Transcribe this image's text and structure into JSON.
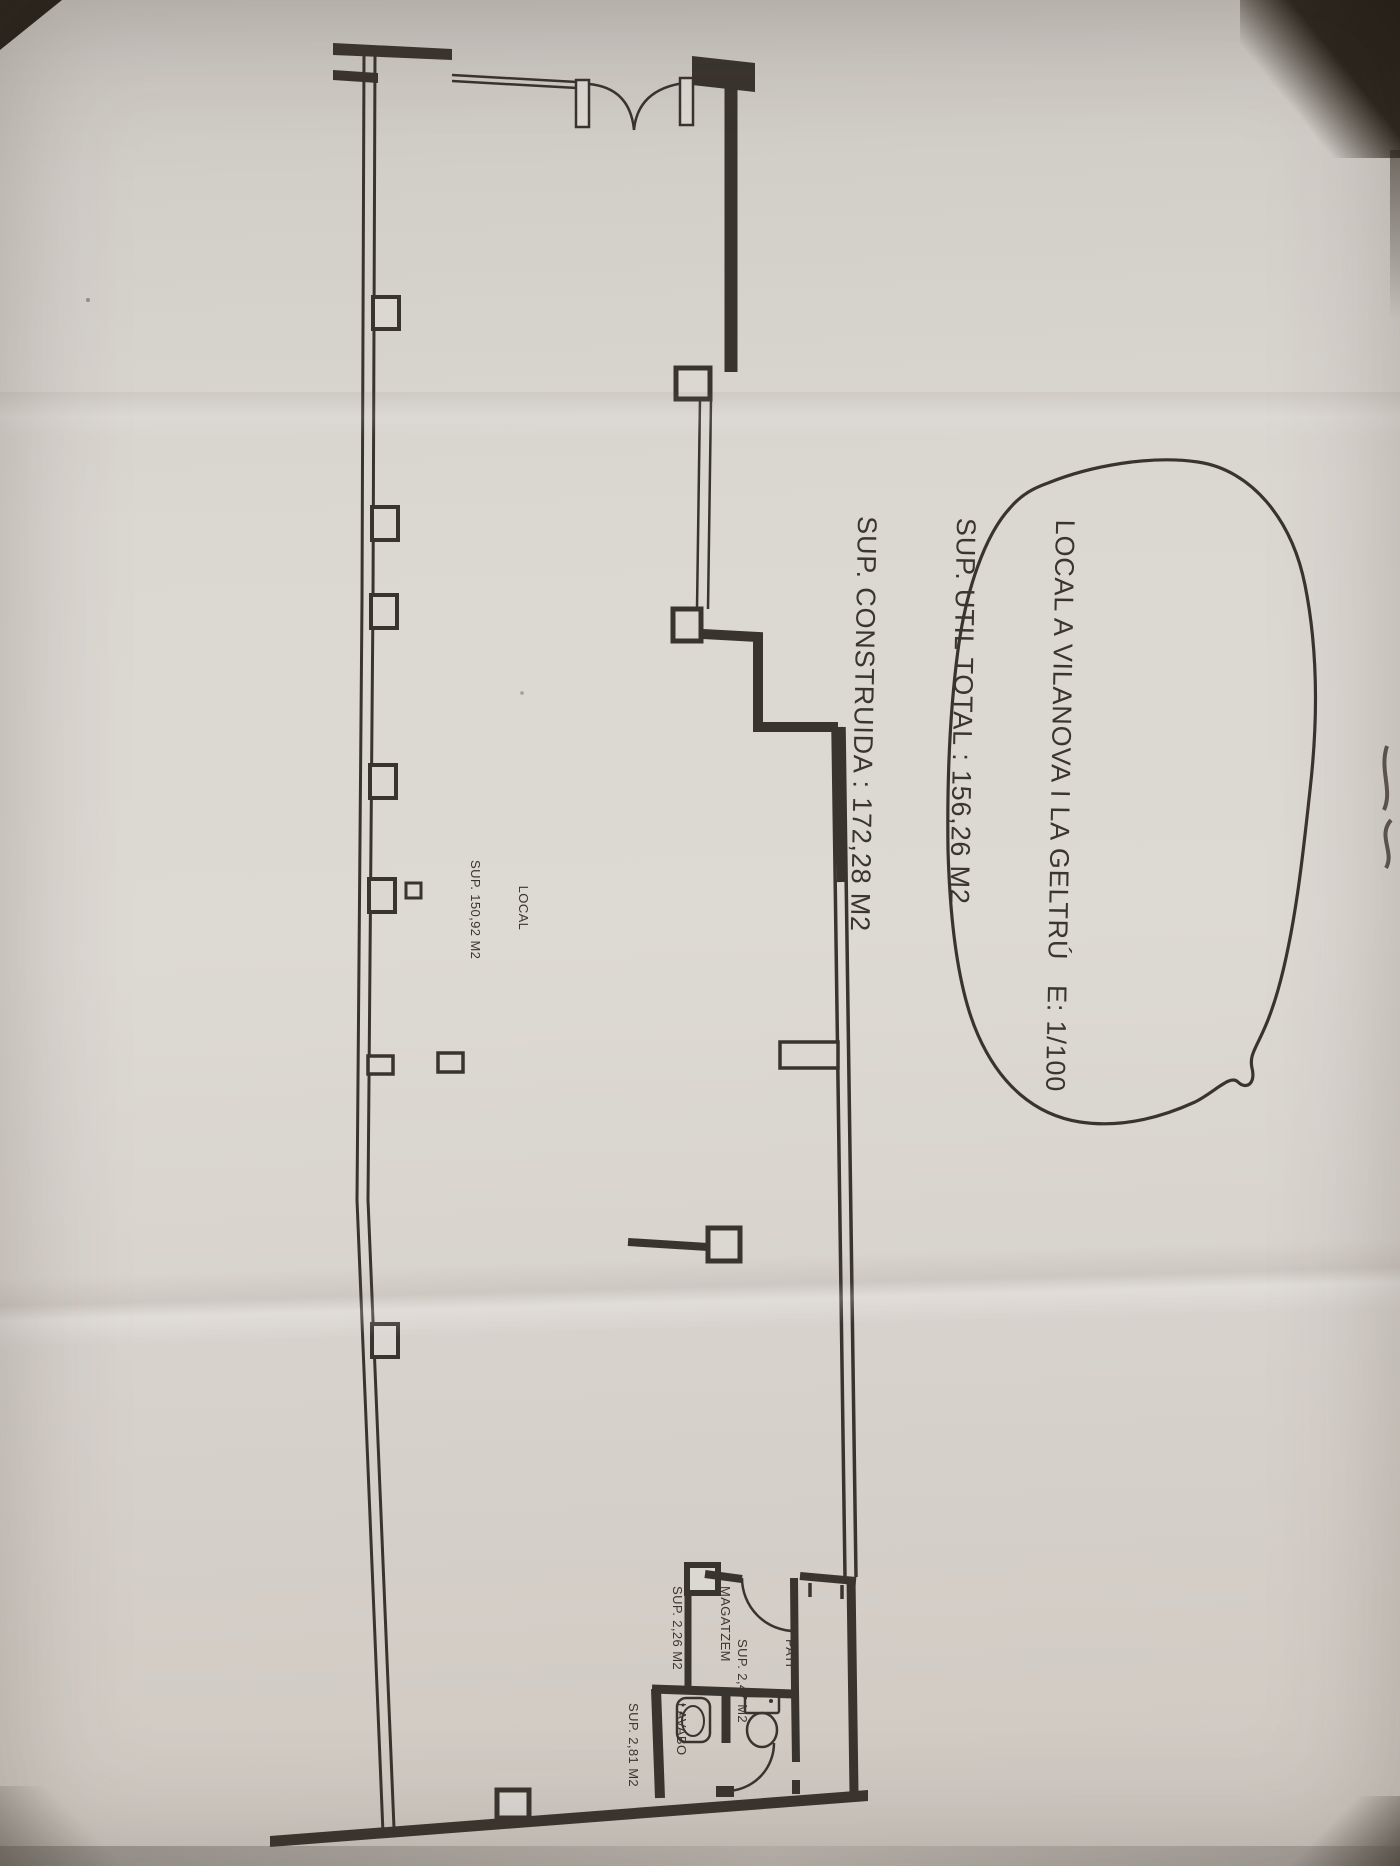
{
  "photo": {
    "annotation_bubble": {
      "lines": [
        "LOCAL A VILANOVA I LA GELTRÚ   E: 1/100",
        "SUP. UTIL TOTAL : 156,26 M2",
        "SUP. CONSTRUIDA : 172,28 M2"
      ]
    },
    "rooms": [
      {
        "name": "LOCAL",
        "area": "SUP. 150,92 M2"
      },
      {
        "name": "MAGATZEM",
        "area": "SUP. 2,26 M2"
      },
      {
        "name": "PATI",
        "area": "SUP. 2,47 M2"
      },
      {
        "name": "LAVABO",
        "area": "SUP. 2,81 M2"
      }
    ],
    "colors": {
      "paper": "#dbd7d1",
      "ink": "#3a342e",
      "photo_shadow": "#262019"
    }
  }
}
